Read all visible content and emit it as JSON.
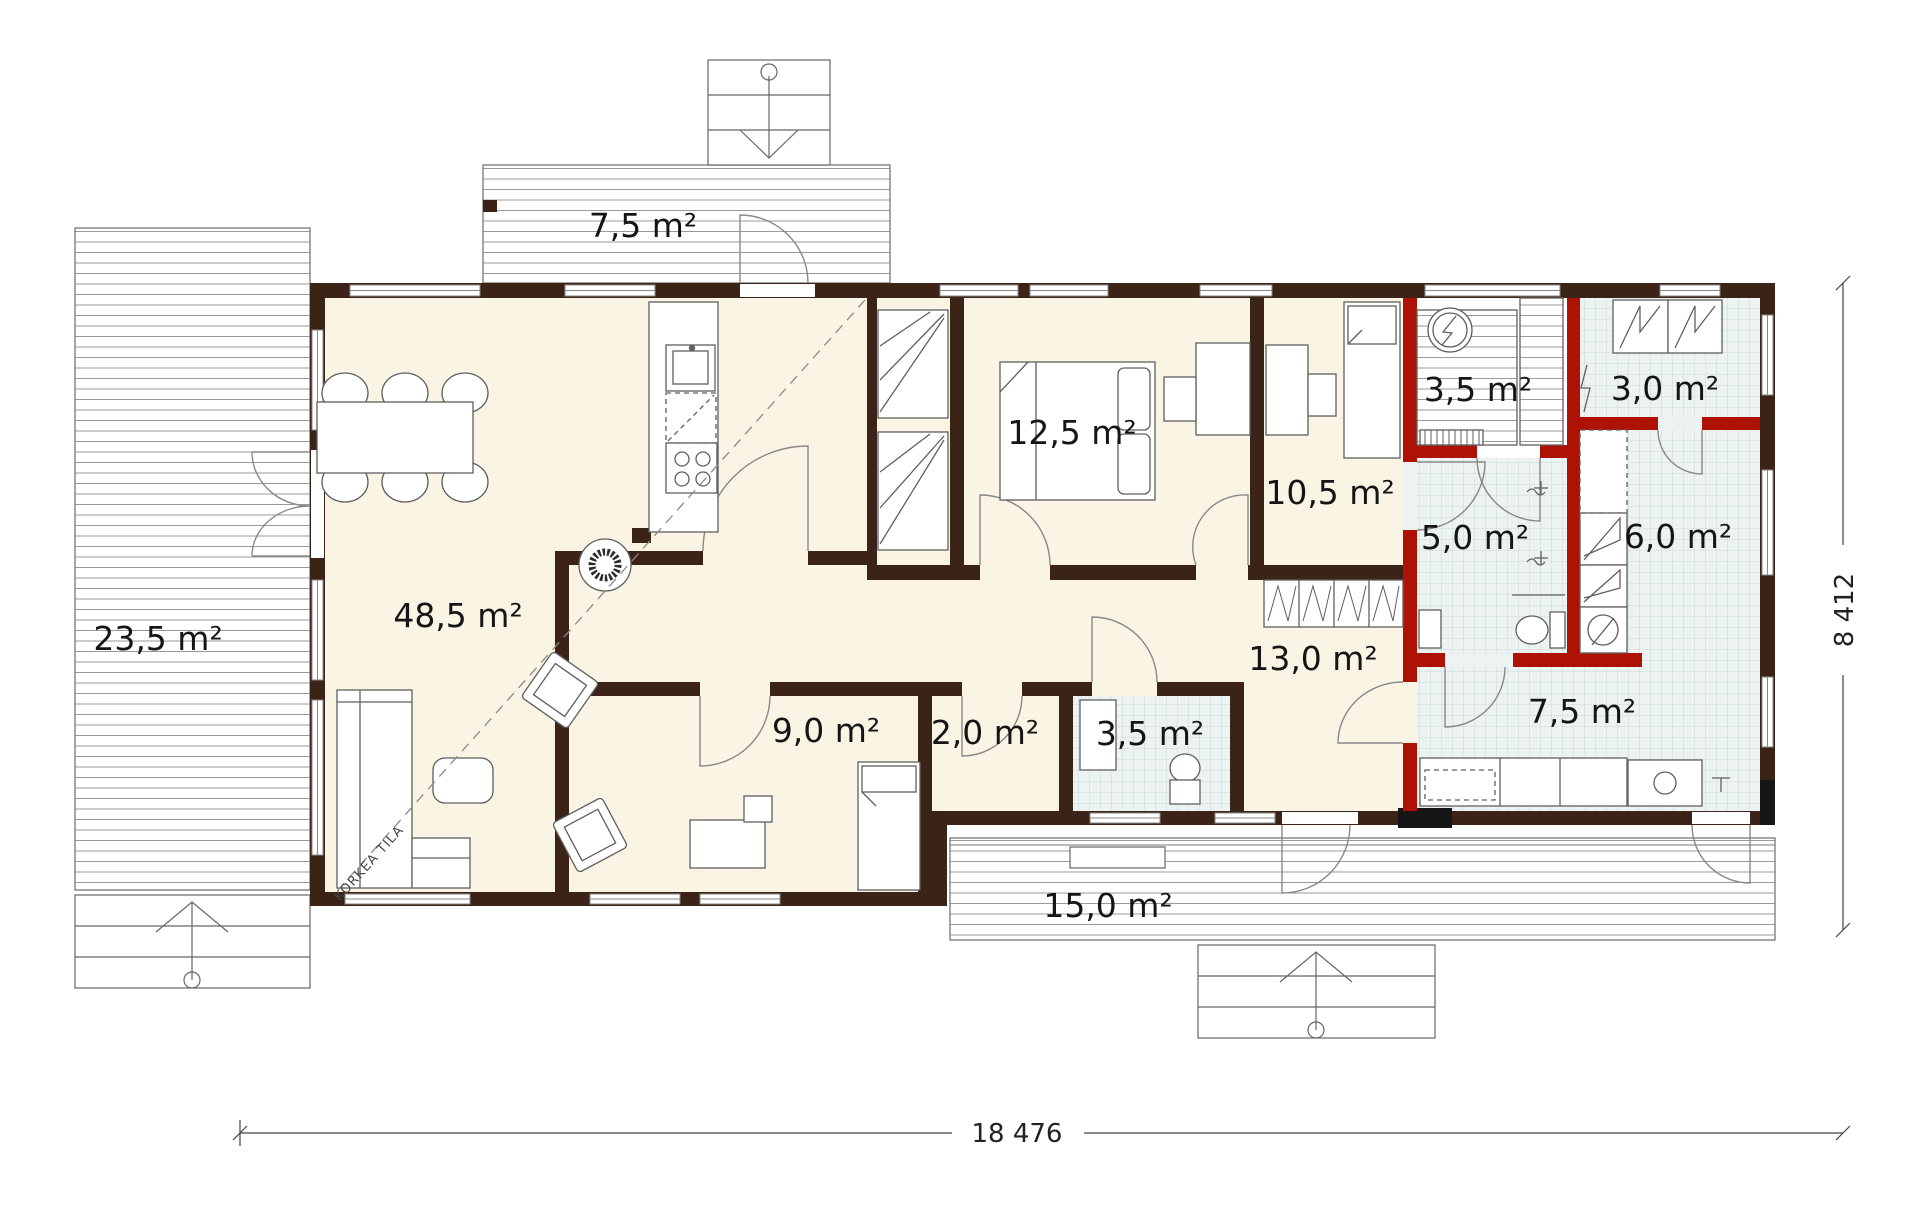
{
  "rooms": [
    {
      "name": "living-dining-kitchen",
      "area_label": "48,5 m²"
    },
    {
      "name": "top-terrace",
      "area_label": "7,5 m²"
    },
    {
      "name": "left-deck",
      "area_label": "23,5 m²"
    },
    {
      "name": "bedroom-master",
      "area_label": "12,5 m²"
    },
    {
      "name": "bedroom-2",
      "area_label": "10,5 m²"
    },
    {
      "name": "sauna",
      "area_label": "3,5 m²"
    },
    {
      "name": "technical-room",
      "area_label": "3,0 m²"
    },
    {
      "name": "bathroom",
      "area_label": "5,0 m²"
    },
    {
      "name": "utility-room",
      "area_label": "6,0 m²"
    },
    {
      "name": "hallway",
      "area_label": "13,0 m²"
    },
    {
      "name": "bedroom-3",
      "area_label": "9,0 m²"
    },
    {
      "name": "closet",
      "area_label": "2,0 m²"
    },
    {
      "name": "wc",
      "area_label": "3,5 m²"
    },
    {
      "name": "laundry-room",
      "area_label": "7,5 m²"
    },
    {
      "name": "bottom-terrace",
      "area_label": "15,0 m²"
    }
  ],
  "annotations": {
    "high_space_label": "KORKEA TILA"
  },
  "dimensions": {
    "overall_width": "18 476",
    "overall_height": "8 412"
  },
  "colors": {
    "wall": "#3b2317",
    "wet_wall": "#ad1205",
    "floor": "#faf4e5",
    "tile_floor": "#edf2f2"
  }
}
